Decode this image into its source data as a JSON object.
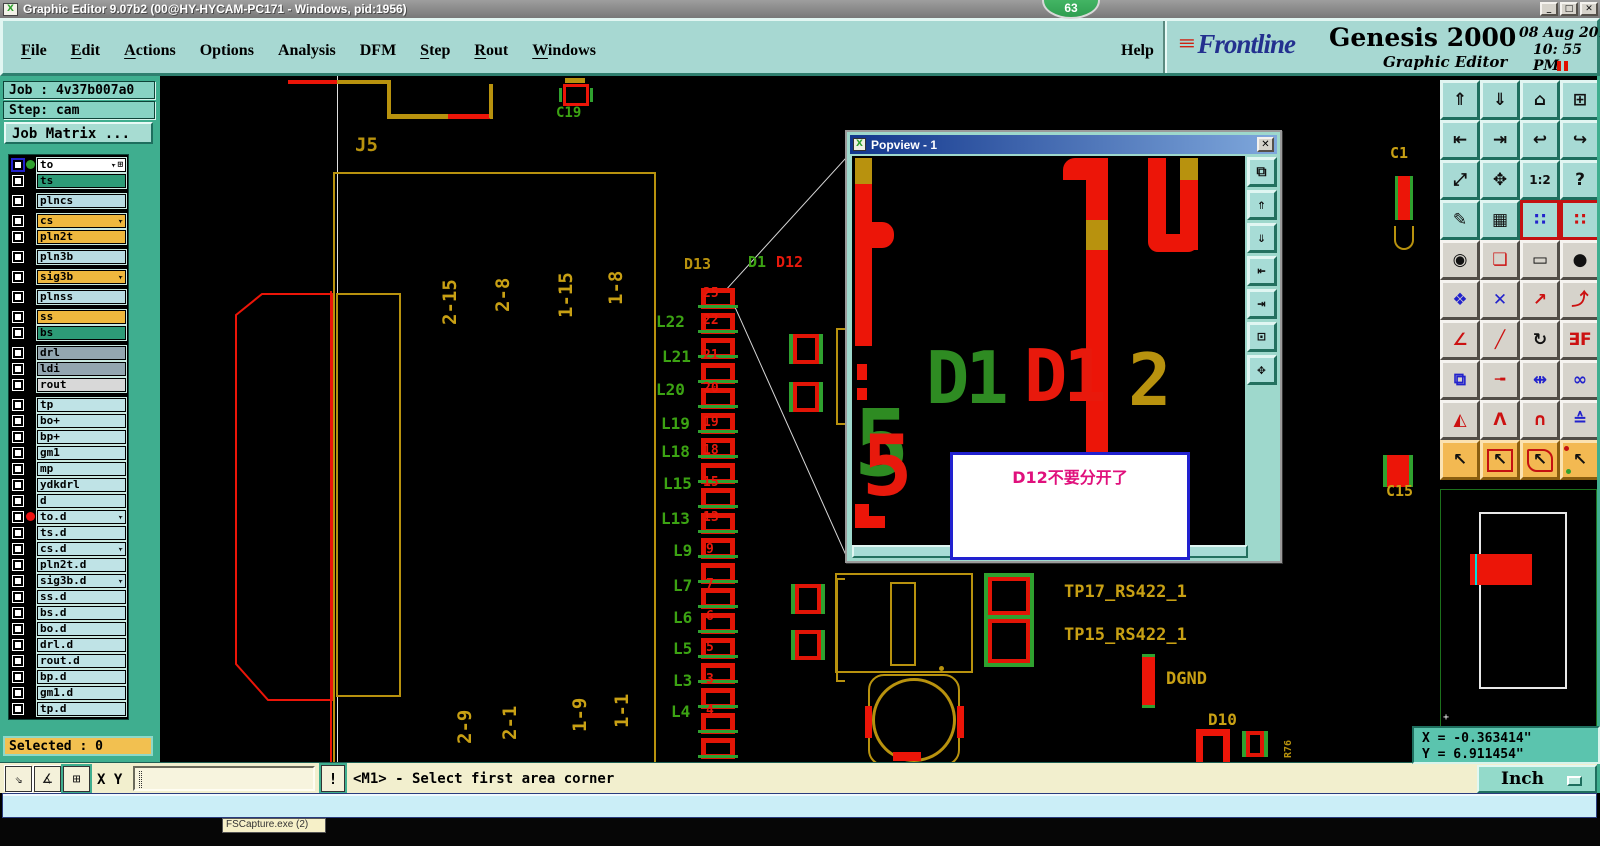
{
  "window": {
    "title": "Graphic Editor 9.07b2 (00@HY-HYCAM-PC171 - Windows, pid:1956)",
    "badge": "63",
    "icon": "X",
    "controls": [
      {
        "name": "minimize-button",
        "glyph": "_"
      },
      {
        "name": "maximize-button",
        "glyph": "□"
      },
      {
        "name": "close-button",
        "glyph": "✕"
      }
    ]
  },
  "menu_bar": {
    "items": [
      {
        "label": "File",
        "underline": 0
      },
      {
        "label": "Edit",
        "underline": 0
      },
      {
        "label": "Actions",
        "underline": 0
      },
      {
        "label": "Options",
        "underline": -1
      },
      {
        "label": "Analysis",
        "underline": -1
      },
      {
        "label": "DFM",
        "underline": -1
      },
      {
        "label": "Step",
        "underline": 0
      },
      {
        "label": "Rout",
        "underline": 0
      },
      {
        "label": "Windows",
        "underline": 0
      }
    ],
    "help": "Help"
  },
  "brand": {
    "logo_arrows": "≡",
    "logo": "Frontline",
    "product": "Genesis 2000",
    "subtitle": "Graphic Editor",
    "date": "08 Aug 2016",
    "time": "10: 55 PM"
  },
  "left_panel": {
    "job": "Job : 4v37b007a0",
    "step": "Step: cam",
    "job_matrix": "Job Matrix ...",
    "selected": "Selected : 0",
    "layers": [
      {
        "name": "to",
        "bg": "white",
        "dot": "green",
        "cursor": true,
        "grid": true,
        "active": true
      },
      {
        "name": "ts",
        "bg": "teal"
      },
      {
        "name": "plncs",
        "bg": "blue",
        "gap": true
      },
      {
        "name": "cs",
        "bg": "orange",
        "gap": true,
        "cursor": true
      },
      {
        "name": "pln2t",
        "bg": "orange"
      },
      {
        "name": "pln3b",
        "bg": "blue",
        "gap": true
      },
      {
        "name": "sig3b",
        "bg": "orange",
        "gap": true,
        "cursor": true
      },
      {
        "name": "plnss",
        "bg": "blue",
        "gap": true
      },
      {
        "name": "ss",
        "bg": "orange",
        "gap": true
      },
      {
        "name": "bs",
        "bg": "teal"
      },
      {
        "name": "drl",
        "bg": "gray",
        "gap": true
      },
      {
        "name": "ldi",
        "bg": "gray"
      },
      {
        "name": "rout",
        "bg": "lgray"
      },
      {
        "name": "tp",
        "bg": "cyan",
        "gap": true
      },
      {
        "name": "bo+",
        "bg": "cyan"
      },
      {
        "name": "bp+",
        "bg": "cyan"
      },
      {
        "name": "gm1",
        "bg": "cyan"
      },
      {
        "name": "mp",
        "bg": "cyan"
      },
      {
        "name": "ydkdrl",
        "bg": "cyan"
      },
      {
        "name": "d",
        "bg": "cyan"
      },
      {
        "name": "to.d",
        "bg": "cyan",
        "dot": "red",
        "cursor": true
      },
      {
        "name": "ts.d",
        "bg": "cyan"
      },
      {
        "name": "cs.d",
        "bg": "cyan",
        "cursor": true
      },
      {
        "name": "pln2t.d",
        "bg": "cyan"
      },
      {
        "name": "sig3b.d",
        "bg": "cyan",
        "cursor": true
      },
      {
        "name": "ss.d",
        "bg": "cyan"
      },
      {
        "name": "bs.d",
        "bg": "cyan"
      },
      {
        "name": "bo.d",
        "bg": "cyan"
      },
      {
        "name": "drl.d",
        "bg": "cyan"
      },
      {
        "name": "rout.d",
        "bg": "cyan"
      },
      {
        "name": "bp.d",
        "bg": "cyan"
      },
      {
        "name": "gm1.d",
        "bg": "cyan"
      },
      {
        "name": "tp.d",
        "bg": "cyan"
      }
    ]
  },
  "toolbar": {
    "buttons": [
      {
        "n": "zoom-in-window-button",
        "g": "⇑",
        "s": "teal"
      },
      {
        "n": "zoom-out-window-button",
        "g": "⇓",
        "s": "teal"
      },
      {
        "n": "home-view-button",
        "g": "⌂",
        "s": "teal"
      },
      {
        "n": "split-view-xy-button",
        "g": "⊞",
        "s": "teal"
      },
      {
        "n": "pan-left-button",
        "g": "⇤",
        "s": "teal"
      },
      {
        "n": "pan-right-button",
        "g": "⇥",
        "s": "teal"
      },
      {
        "n": "previous-view-button",
        "g": "↩",
        "s": "teal"
      },
      {
        "n": "profile-view-button",
        "g": "↪",
        "s": "teal"
      },
      {
        "n": "zoom-fit-button",
        "g": "⤢",
        "s": "teal"
      },
      {
        "n": "center-view-button",
        "g": "✥",
        "s": "teal"
      },
      {
        "n": "zoom-ratio-button",
        "g": "1:2",
        "s": "teal"
      },
      {
        "n": "help-pointer-button",
        "g": "?",
        "s": "teal"
      },
      {
        "n": "setup-tools-button",
        "g": "✎",
        "s": "teal"
      },
      {
        "n": "grid-toggle-button",
        "g": "▦",
        "s": "teal"
      },
      {
        "n": "layer-display-button",
        "g": "∷",
        "s": "teal",
        "v": "red",
        "col": "#2222CC"
      },
      {
        "n": "layer-display-alt-button",
        "g": "∷",
        "s": "teal",
        "v": "red",
        "col": "#CC1111"
      },
      {
        "n": "select-feature-button",
        "g": "◉",
        "s": "gray"
      },
      {
        "n": "profile-edit-button",
        "g": "❏",
        "s": "gray",
        "col": "#CC1111"
      },
      {
        "n": "measure-button",
        "g": "▭",
        "s": "gray"
      },
      {
        "n": "pad-fill-button",
        "g": "●",
        "s": "gray"
      },
      {
        "n": "net-select-button",
        "g": "❖",
        "s": "gray",
        "col": "#2222CC"
      },
      {
        "n": "delete-feature-button",
        "g": "✕",
        "s": "gray",
        "col": "#2222CC"
      },
      {
        "n": "move-point-button",
        "g": "↗",
        "s": "gray",
        "col": "#CC1111"
      },
      {
        "n": "copy-point-button",
        "g": "⤴",
        "s": "gray",
        "col": "#CC1111"
      },
      {
        "n": "angle-measure-button",
        "g": "∠",
        "s": "gray",
        "col": "#CC1111"
      },
      {
        "n": "slope-measure-button",
        "g": "╱",
        "s": "gray",
        "col": "#CC1111"
      },
      {
        "n": "rotate-button",
        "g": "↻",
        "s": "gray"
      },
      {
        "n": "mirror-button",
        "g": "∃F",
        "s": "gray",
        "col": "#CC1111"
      },
      {
        "n": "copy-pad-button",
        "g": "⧉",
        "s": "gray",
        "col": "#2222CC"
      },
      {
        "n": "stretch-line-button",
        "g": "╼",
        "s": "gray",
        "col": "#CC1111"
      },
      {
        "n": "dimension-button",
        "g": "⇹",
        "s": "gray",
        "col": "#2222CC"
      },
      {
        "n": "join-shapes-button",
        "g": "∞",
        "s": "gray",
        "col": "#2222CC"
      },
      {
        "n": "peak-small-button",
        "g": "◭",
        "s": "gray",
        "col": "#CC1111"
      },
      {
        "n": "peak-button",
        "g": "Λ",
        "s": "gray",
        "col": "#CC1111"
      },
      {
        "n": "arch-button",
        "g": "∩",
        "s": "gray",
        "col": "#CC1111"
      },
      {
        "n": "arch-wide-button",
        "g": "≙",
        "s": "gray",
        "col": "#2222CC"
      },
      {
        "n": "select-pointer-button",
        "g": "↖",
        "s": "orange"
      },
      {
        "n": "select-frame-button",
        "g": "↖",
        "s": "orange",
        "v": "frame"
      },
      {
        "n": "select-polygon-button",
        "g": "↖",
        "s": "orange",
        "v": "poly"
      },
      {
        "n": "select-net-button",
        "g": "↖",
        "s": "orange",
        "v": "net"
      }
    ]
  },
  "canvas": {
    "pad_count": 19,
    "labels": [
      {
        "t": "J5",
        "x": 355,
        "y": 136,
        "c": "#B8920E",
        "s": 19
      },
      {
        "t": "C19",
        "x": 556,
        "y": 106,
        "c": "#3CA313",
        "s": 14
      },
      {
        "t": "D13",
        "x": 684,
        "y": 257,
        "c": "#B8920E",
        "s": 15
      },
      {
        "t": "D1",
        "x": 748,
        "y": 255,
        "c": "#3CA313",
        "s": 15
      },
      {
        "t": "D12",
        "x": 776,
        "y": 255,
        "c": "#E8190C",
        "s": 15
      },
      {
        "t": "L22",
        "x": 656,
        "y": 314,
        "c": "#3CA313",
        "s": 16
      },
      {
        "t": "L21",
        "x": 662,
        "y": 349,
        "c": "#3CA313",
        "s": 16
      },
      {
        "t": "L20",
        "x": 656,
        "y": 382,
        "c": "#3CA313",
        "s": 16
      },
      {
        "t": "L19",
        "x": 661,
        "y": 416,
        "c": "#3CA313",
        "s": 16
      },
      {
        "t": "L18",
        "x": 661,
        "y": 444,
        "c": "#3CA313",
        "s": 16
      },
      {
        "t": "L15",
        "x": 663,
        "y": 476,
        "c": "#3CA313",
        "s": 16
      },
      {
        "t": "L13",
        "x": 661,
        "y": 511,
        "c": "#3CA313",
        "s": 16
      },
      {
        "t": "L9",
        "x": 673,
        "y": 543,
        "c": "#3CA313",
        "s": 16
      },
      {
        "t": "L7",
        "x": 673,
        "y": 578,
        "c": "#3CA313",
        "s": 16
      },
      {
        "t": "L6",
        "x": 673,
        "y": 610,
        "c": "#3CA313",
        "s": 16
      },
      {
        "t": "L5",
        "x": 673,
        "y": 641,
        "c": "#3CA313",
        "s": 16
      },
      {
        "t": "L3",
        "x": 673,
        "y": 673,
        "c": "#3CA313",
        "s": 16
      },
      {
        "t": "L4",
        "x": 671,
        "y": 704,
        "c": "#3CA313",
        "s": 16
      },
      {
        "t": "25",
        "x": 703,
        "y": 287,
        "c": "#E8190C",
        "s": 13
      },
      {
        "t": "22",
        "x": 703,
        "y": 314,
        "c": "#E8190C",
        "s": 13
      },
      {
        "t": "21",
        "x": 703,
        "y": 349,
        "c": "#E8190C",
        "s": 13
      },
      {
        "t": "20",
        "x": 703,
        "y": 382,
        "c": "#E8190C",
        "s": 13
      },
      {
        "t": "19",
        "x": 703,
        "y": 416,
        "c": "#E8190C",
        "s": 13
      },
      {
        "t": "18",
        "x": 703,
        "y": 444,
        "c": "#E8190C",
        "s": 13
      },
      {
        "t": "15",
        "x": 703,
        "y": 476,
        "c": "#E8190C",
        "s": 13
      },
      {
        "t": "13",
        "x": 703,
        "y": 511,
        "c": "#E8190C",
        "s": 13
      },
      {
        "t": "9",
        "x": 706,
        "y": 543,
        "c": "#E8190C",
        "s": 13
      },
      {
        "t": "7",
        "x": 706,
        "y": 578,
        "c": "#E8190C",
        "s": 13
      },
      {
        "t": "6",
        "x": 706,
        "y": 610,
        "c": "#E8190C",
        "s": 13
      },
      {
        "t": "5",
        "x": 706,
        "y": 641,
        "c": "#E8190C",
        "s": 13
      },
      {
        "t": "3",
        "x": 706,
        "y": 673,
        "c": "#E8190C",
        "s": 13
      },
      {
        "t": "4",
        "x": 706,
        "y": 704,
        "c": "#E8190C",
        "s": 13
      },
      {
        "t": "2-15",
        "x": 441,
        "y": 325,
        "c": "#C8A014",
        "s": 19,
        "r": 1
      },
      {
        "t": "2-8",
        "x": 494,
        "y": 312,
        "c": "#C8A014",
        "s": 19,
        "r": 1
      },
      {
        "t": "1-15",
        "x": 557,
        "y": 318,
        "c": "#C8A014",
        "s": 19,
        "r": 1
      },
      {
        "t": "1-8",
        "x": 607,
        "y": 305,
        "c": "#C8A014",
        "s": 19,
        "r": 1
      },
      {
        "t": "2-9",
        "x": 456,
        "y": 744,
        "c": "#C8A014",
        "s": 19,
        "r": 1
      },
      {
        "t": "2-1",
        "x": 501,
        "y": 740,
        "c": "#C8A014",
        "s": 19,
        "r": 1
      },
      {
        "t": "1-9",
        "x": 571,
        "y": 732,
        "c": "#C8A014",
        "s": 19,
        "r": 1
      },
      {
        "t": "1-1",
        "x": 613,
        "y": 728,
        "c": "#C8A014",
        "s": 19,
        "r": 1
      },
      {
        "t": "TP17_RS422_1",
        "x": 1064,
        "y": 584,
        "c": "#C8A014",
        "s": 17
      },
      {
        "t": "TP15_RS422_1",
        "x": 1064,
        "y": 627,
        "c": "#C8A014",
        "s": 17
      },
      {
        "t": "DGND",
        "x": 1166,
        "y": 671,
        "c": "#C8A014",
        "s": 17
      },
      {
        "t": "D10",
        "x": 1208,
        "y": 712,
        "c": "#C8A014",
        "s": 16
      },
      {
        "t": "R76",
        "x": 1284,
        "y": 758,
        "c": "#B8920E",
        "s": 10,
        "r": 1
      },
      {
        "t": "C15",
        "x": 1386,
        "y": 484,
        "c": "#C8A014",
        "s": 15
      },
      {
        "t": "C1",
        "x": 1390,
        "y": 146,
        "c": "#C8A014",
        "s": 15
      }
    ]
  },
  "popview": {
    "title": "Popview - 1",
    "icon": "X",
    "close": "✕",
    "note": "D12不要分开了",
    "labels": [
      {
        "t": "D1",
        "x": 74,
        "y": 186,
        "c": "#2E8B22",
        "s": 72
      },
      {
        "t": "D1",
        "x": 172,
        "y": 184,
        "c": "#E8190C",
        "s": 72
      },
      {
        "t": "2",
        "x": 276,
        "y": 188,
        "c": "#B8920E",
        "s": 72
      },
      {
        "t": "5",
        "x": 2,
        "y": 242,
        "c": "#2E8B22",
        "s": 92
      },
      {
        "t": "5",
        "x": 10,
        "y": 268,
        "c": "#E8190C",
        "s": 84
      }
    ],
    "side_buttons": [
      {
        "n": "popview-clone-button",
        "g": "⧉"
      },
      {
        "n": "popview-zoom-in-button",
        "g": "⇑"
      },
      {
        "n": "popview-zoom-out-button",
        "g": "⇓"
      },
      {
        "n": "popview-pan-left-button",
        "g": "⇤"
      },
      {
        "n": "popview-pan-right-button",
        "g": "⇥"
      },
      {
        "n": "popview-shrink-button",
        "g": "⊡"
      },
      {
        "n": "popview-expand-button",
        "g": "✥"
      }
    ]
  },
  "coords": {
    "x": "X = -0.363414\"",
    "y": "Y = 6.911454\""
  },
  "status": {
    "xy": "X Y :",
    "input": "",
    "bang": "!",
    "message": "<M1> - Select first area corner",
    "units": "Inch"
  },
  "taskbar": {
    "tooltip": "FSCapture.exe (2)"
  }
}
